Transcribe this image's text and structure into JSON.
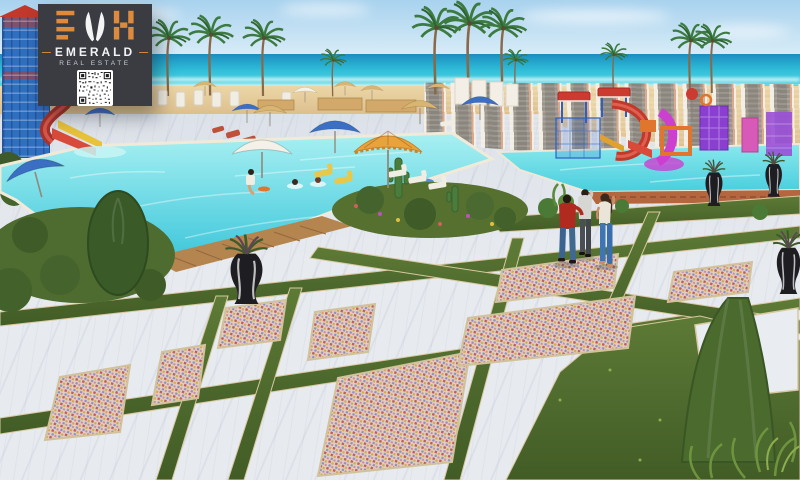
{
  "logo": {
    "monogram": "EMH",
    "brand": "EMERALD",
    "tagline": "REAL ESTATE",
    "dash": "—"
  },
  "scene": {
    "description": "3D architectural rendering of a beachfront resort: main swimming pool with swimmers and a water-slide tower, kids aqua park with colorful slides behind a white perforated wall, palm-lined beach with cabanas and straw umbrellas, marble promenade with mosaic inlays and grass joints, landscaped gardens with cacti and planter vases, and three people standing on the plaza.",
    "palette": {
      "sky_top": "#a8d2ee",
      "sky_bottom": "#dceef8",
      "sea_deep": "#1b8ec0",
      "sea_mid": "#2fbdd8",
      "sea_light": "#55d6e2",
      "sand": "#ecd6a6",
      "sand_deep": "#d9b987",
      "marble": "#e7eaef",
      "grass": "#55702f",
      "pool": "#3ec8dc",
      "pool_light": "#a8f0f2",
      "lattice_frame": "#f2eee4",
      "lattice_mesh": "#8a857d",
      "terracotta": "#b4663f",
      "wood": "#b5854f",
      "frame_blue": "#2f6fc0",
      "slide_red": "#c0392b",
      "park_magenta": "#cc3fcf",
      "park_purple": "#8a3fd1",
      "park_orange": "#e0762e",
      "umbrella_blue": "#3a6fc4",
      "umbrella_white": "#f4f1e8",
      "umbrella_orange": "#e8a33c",
      "umbrella_straw": "#d9b572",
      "vase_black": "#1d1d22",
      "jeans_blue": "#3f74b5",
      "shirt_red": "#b12a20",
      "logo_card": "#3a3c42",
      "logo_accent": "#de8a3c",
      "logo_text": "#f2f3f5"
    }
  }
}
